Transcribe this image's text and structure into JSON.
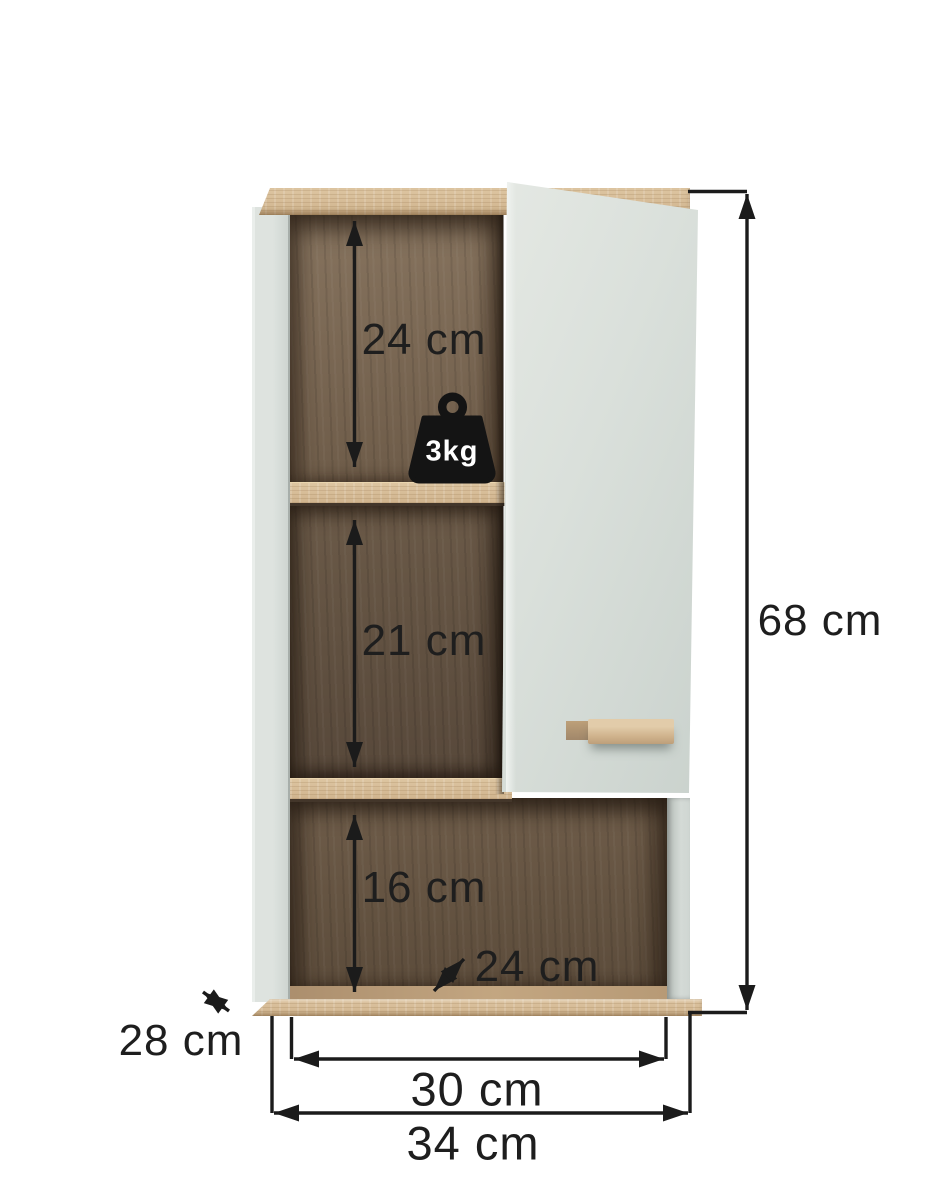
{
  "diagram": {
    "type": "furniture-dimension-diagram",
    "subject": "wall-mounted bathroom cabinet with open door, oak interior",
    "unit": "cm"
  },
  "labels": {
    "top_section": "24 cm",
    "middle_section": "21 cm",
    "bottom_section": "16 cm",
    "height": "68 cm",
    "depth": "28 cm",
    "inner_depth": "24 cm",
    "inner_width": "30 cm",
    "width": "34 cm",
    "max_load": "3kg"
  },
  "icons": {
    "weight": "weight-3kg-icon",
    "arrows": "double-headed-dimension-arrows"
  },
  "colors": {
    "background": "#ffffff",
    "door_front": "#d9dfda",
    "side_panel": "#dde2de",
    "oak_light": "#d8c09b",
    "oak_interior_dark": "#665545",
    "dimension_line": "#1b1b1b",
    "weight_icon": "#141414",
    "weight_text": "#ffffff"
  }
}
